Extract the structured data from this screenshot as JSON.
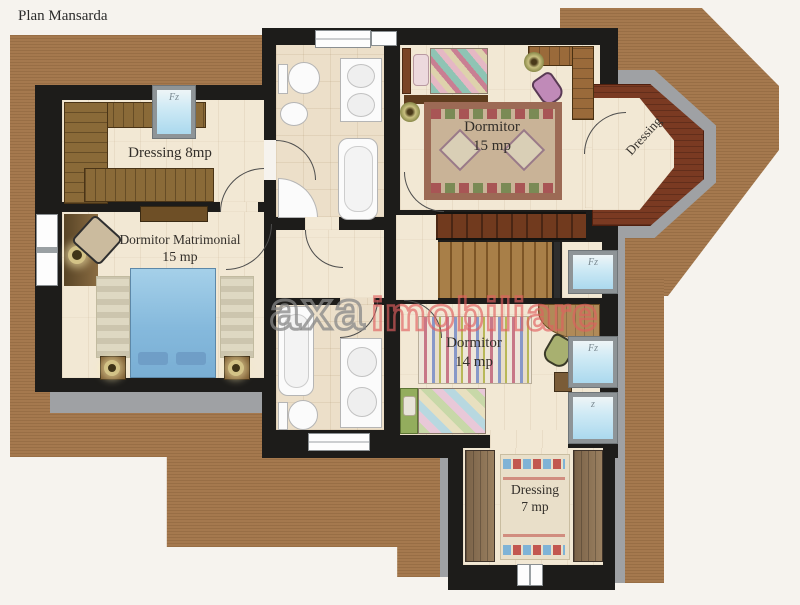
{
  "title": "Plan Mansarda",
  "watermark": {
    "brand_primary": "axa",
    "brand_secondary": "imobiliare"
  },
  "rooms": {
    "dressing8": {
      "label": "Dressing 8mp"
    },
    "dormitor_matrimonial": {
      "name": "Dormitor Matrimonial",
      "area": "15 mp"
    },
    "dormitor15": {
      "name": "Dormitor",
      "area": "15 mp"
    },
    "dressing_bay": {
      "label": "Dressing"
    },
    "dormitor14": {
      "name": "Dormitor",
      "area": "14 mp"
    },
    "dressing7": {
      "name": "Dressing",
      "area": "7 mp"
    }
  },
  "windows": {
    "dressing8_window": "Fz",
    "stairs_window": "Fz",
    "dormitor14_window_upper": "Fz",
    "dormitor14_window_lower": "z"
  },
  "colors": {
    "terrace_brown": "#a3764a",
    "wall_black": "#1d1c1a",
    "gray_band": "#9fa1a4",
    "floor_wood": "#f2e8d4",
    "bed_blue": "#85b9dc",
    "watermark_gray": "#878787",
    "watermark_red": "#e06060"
  }
}
